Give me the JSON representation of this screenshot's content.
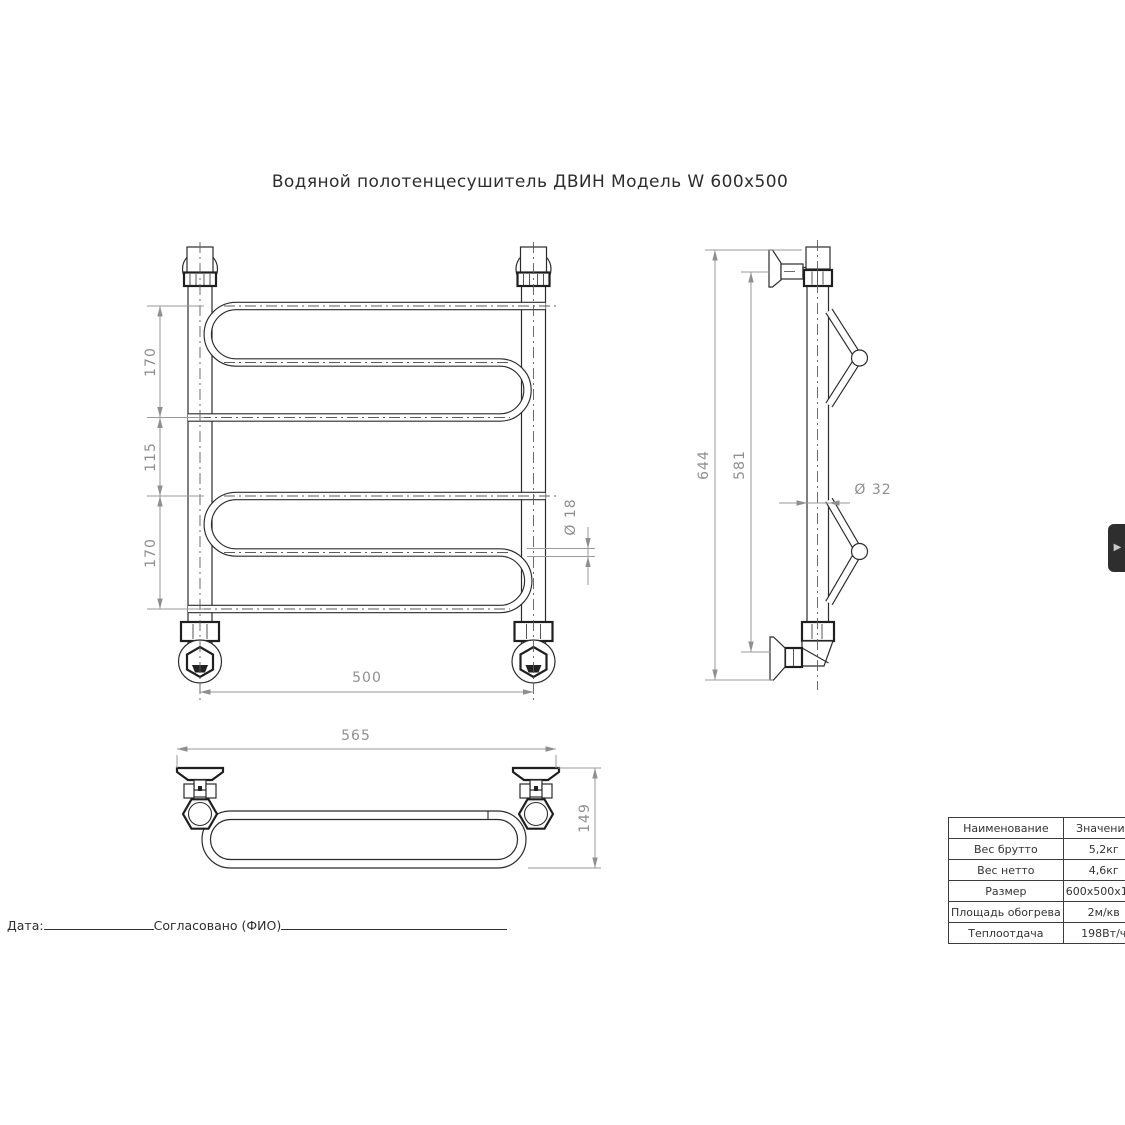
{
  "title": "Водяной полотенцесушитель ДВИН Модель W 600x500",
  "views": {
    "front": {
      "dims": {
        "top_section": "170",
        "middle_section": "115",
        "bottom_section": "170",
        "tube_diameter": "Ø 18",
        "axes_width": "500"
      }
    },
    "side": {
      "dims": {
        "overall_height": "644",
        "mount_distance": "581",
        "collector_diameter": "Ø 32"
      }
    },
    "plan": {
      "dims": {
        "overall_width": "565",
        "depth": "149"
      }
    }
  },
  "spec_table": {
    "rows": [
      {
        "name": "Наименование",
        "value": "Значение"
      },
      {
        "name": "Вес брутто",
        "value": "5,2кг"
      },
      {
        "name": "Вес нетто",
        "value": "4,6кг"
      },
      {
        "name": "Размер",
        "value": "600x500x150"
      },
      {
        "name": "Площадь обогрева",
        "value": "2м/кв"
      },
      {
        "name": "Теплоотдача",
        "value": "198Вт/ч"
      }
    ]
  },
  "footer": {
    "date_label": "Дата:",
    "approved_label": "Согласовано (ФИО)"
  },
  "side_panel": {
    "expand_icon": "▶"
  },
  "colors": {
    "line": "#2b2b2b",
    "dimension": "#8f8f8f",
    "tab_background": "#2e2e2e",
    "tab_arrow": "#c9c9c9"
  }
}
